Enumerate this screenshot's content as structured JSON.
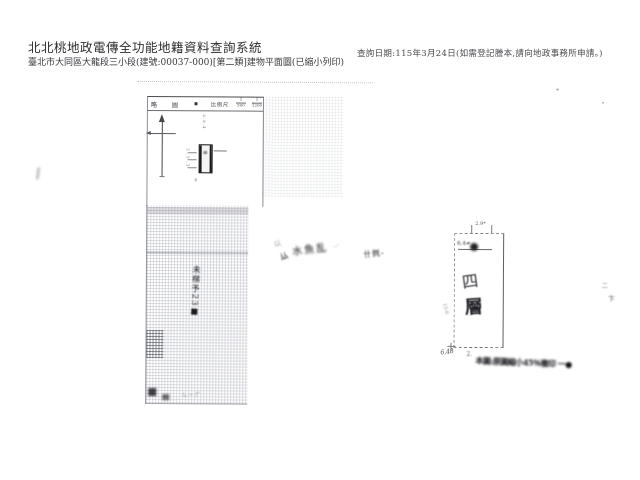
{
  "header": {
    "system_title": "北北桃地政電傳全功能地籍資料查詢系統",
    "document_title": "臺北市大同區大龍段三小段(建號:00037-000)[第二類]建物平面圖(已縮小列印)",
    "query_note": "查詢日期:115年3月24日(如需登記謄本,請向地政事務所申請。)"
  },
  "form": {
    "header_cells": {
      "c1": "略",
      "c2": "圖",
      "c3": "▪",
      "scale_label": "比例尺"
    },
    "scales": {
      "s1_num": "1",
      "s1_den": "500",
      "s2_num": "1",
      "s2_den": "1200"
    }
  },
  "mini_plan": {
    "dim_top": "3.0.4",
    "dim_left": "2.5.3",
    "dim_bottom": "6",
    "inner_mark": "≡"
  },
  "floor_plan": {
    "floor_char_top": "四",
    "floor_char_bottom": "層",
    "dim_top": "2.9*",
    "dim_inner": "6.4≠",
    "dim_left": "13-6",
    "dim_bottom": "6.48"
  },
  "handwriting": {
    "ghost": "以",
    "note_main": "水魚乱",
    "note_trail": "‥·",
    "note_low": "厸",
    "note_b": "卄毿‐",
    "vertical_note": "未梯予23■",
    "grid_scribble": "し⌐厂"
  },
  "stamp": {
    "lead": "2.",
    "text": "本圖:原圖縮小45％複印 一●"
  },
  "faint_marks": {
    "m1": "二",
    "m2": "卞"
  }
}
